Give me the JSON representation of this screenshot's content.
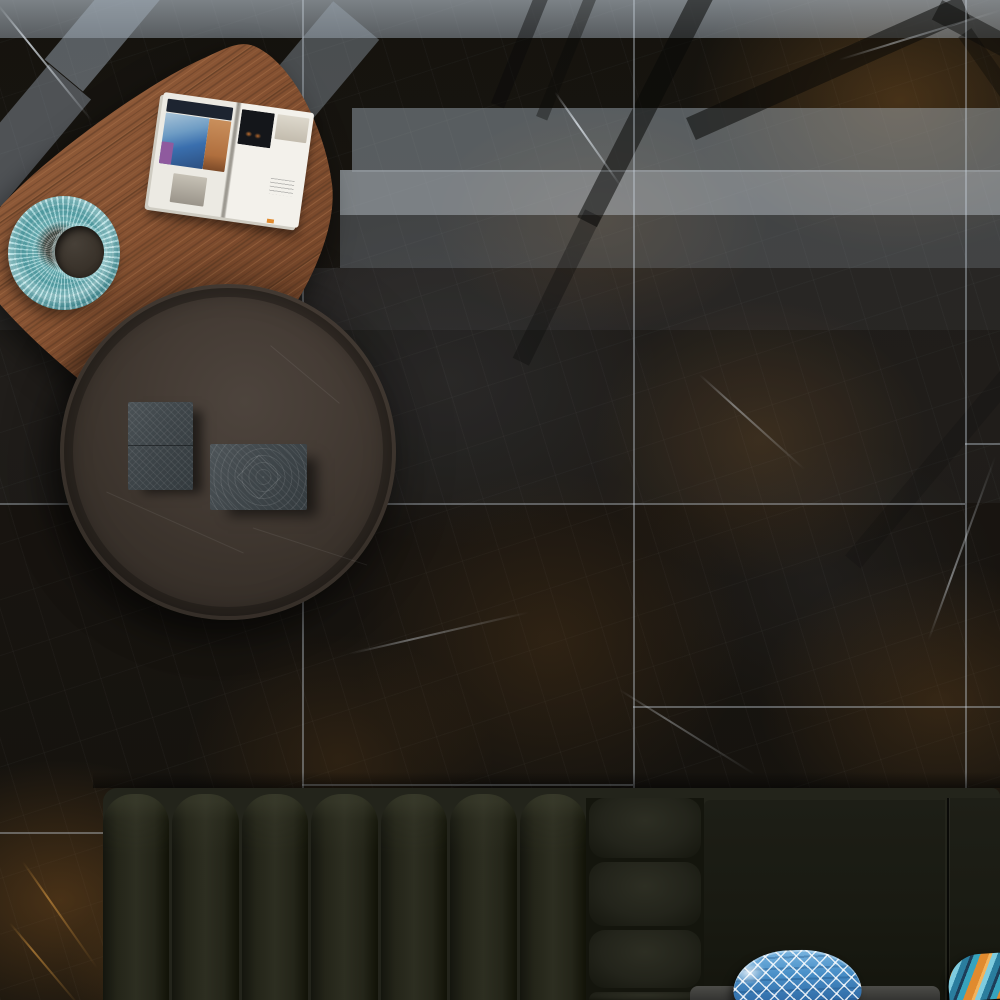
{
  "scene": {
    "type": "interior-photograph-top-down",
    "description": "Top-down showroom photo of a dark polished marble tile floor with amber and white veining. Window-light reflections make bright horizontal bands across the upper third, crossed by dark diagonal window-frame shadows forming a chevron near the top right. A freeform walnut coffee table (upper left) holds an open interior-design magazine; a teal woven bowl with a dark center sits at its left edge. A round matte dark-bronze side table with two etched gray boxes overlaps the wooden table. A dark olive channel-tufted sofa runs along the bottom with a blue ikat pillow and an orange striped pillow."
  },
  "palette": {
    "floor-base": "#17140f",
    "floor-vein-amber": "#a87635",
    "floor-vein-white": "#e8f0f7",
    "grout": "#cdd7e1",
    "reflection-light": "#aebac6",
    "wood-mid": "#8a5639",
    "wood-dark": "#5e3a24",
    "wood-light": "#a9714a",
    "round-table-top": "#3f3831",
    "box-gray": "#424a4e",
    "sofa-base": "#20211a",
    "sofa-rail": "#23241b",
    "sofa-highlight": "#2e2f24",
    "bowl-teal": "#6fbcc2",
    "bowl-teal-light": "#a8dde0",
    "bowl-center": "#3a332b",
    "page-white": "#eceae3",
    "pillow-blue": "#4a90c8",
    "pillow-orange": "#e08a2e",
    "pillow-teal": "#2a7d9e"
  },
  "floor": {
    "material": "dark brown/black marble, gold-amber veining, fine white veins, polished",
    "tile_joint_vertical_x": [
      302,
      633,
      965
    ],
    "tile_joint_horizontal": [
      {
        "y": 503,
        "x_from": 0,
        "x_to": 965
      },
      {
        "y": 443,
        "x_from": 965,
        "x_to": 1000
      },
      {
        "y": 706,
        "x_from": 633,
        "x_to": 1000
      },
      {
        "y": 784,
        "x_from": 302,
        "x_to": 633
      },
      {
        "y": 832,
        "x_from": 0,
        "x_to": 302
      },
      {
        "y": 170,
        "x_from": 352,
        "x_to": 1000
      }
    ],
    "reflection_bands_y": [
      [
        0,
        38
      ],
      [
        108,
        170
      ],
      [
        170,
        215
      ],
      [
        215,
        268
      ],
      [
        268,
        330
      ]
    ],
    "window_frame_shadow": "dark diagonal stripes, chevron apex near x=965 y=0"
  },
  "objects": [
    {
      "name": "wooden-coffee-table",
      "shape": "freeform rounded triangle",
      "bbox": [
        0,
        40,
        340,
        425
      ],
      "material": "walnut wood, diagonal grain"
    },
    {
      "name": "open-magazine",
      "bbox": [
        155,
        102,
        310,
        222
      ],
      "rotation_deg": 8,
      "content": "interior-design spread: left page photo collage in blue, orange and purple over white; right page mostly white with dark photo block and faint text"
    },
    {
      "name": "decorative-bowl",
      "bbox": [
        8,
        196,
        120,
        310
      ],
      "style": "teal woven perforated bowl, offset dark interior"
    },
    {
      "name": "round-side-table",
      "bbox": [
        60,
        284,
        396,
        620
      ],
      "style": "matte dark bronze-brown circular top with faint scratches and recessed rim"
    },
    {
      "name": "decorative-box-small",
      "bbox": [
        128,
        402,
        193,
        490
      ],
      "style": "slate gray, diagonal etched lines, mid seam"
    },
    {
      "name": "decorative-box-large",
      "bbox": [
        210,
        444,
        307,
        510
      ],
      "style": "slate gray, concentric diamond etching"
    },
    {
      "name": "sofa",
      "bbox": [
        103,
        788,
        1000,
        1000
      ],
      "details": {
        "channel_count": 7,
        "arm_stack_blocks": 4,
        "sections": [
          "channel-tufted backrest",
          "stacked arm cushions",
          "plain back panel",
          "plain back panel right of seam x=945"
        ],
        "fabric": "dark olive velvet"
      }
    },
    {
      "name": "seat-edge",
      "bbox": [
        690,
        986,
        940,
        1000
      ],
      "style": "gray upholstered edge sliver"
    },
    {
      "name": "pillow-blue-ikat",
      "bbox": [
        733,
        950,
        861,
        1000
      ],
      "pattern": "white diamond ikat lattice on blue"
    },
    {
      "name": "pillow-orange-stripe",
      "bbox": [
        948,
        954,
        1000,
        1000
      ],
      "pattern": "diagonal stripes orange / light blue / teal / navy"
    }
  ]
}
